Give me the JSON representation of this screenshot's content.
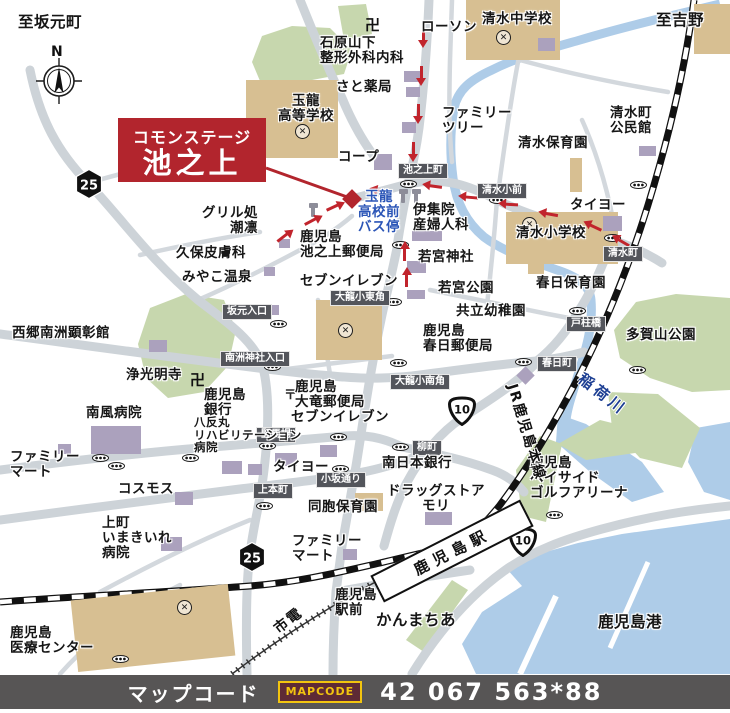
{
  "title_box": {
    "line1": "コモンステージ",
    "line2": "池之上"
  },
  "compass": {
    "label": "N"
  },
  "footer": {
    "label": "マップコード",
    "logo": "MAPCODE",
    "code": "42 067 563*88"
  },
  "station": {
    "name": "鹿児島駅"
  },
  "colors": {
    "accent_red": "#b2252d",
    "road": "#cdd3d8",
    "water": "#aecce8",
    "park_green": "#c7d7ae",
    "school_tan": "#d7bf92",
    "building_purple": "#aba1bd",
    "plate_bg": "#53555b",
    "footer_bg": "#575555",
    "mapcode_yellow": "#f2c40f"
  },
  "route_badges": [
    {
      "shape": "hex",
      "num": "25",
      "x": 89,
      "y": 184
    },
    {
      "shape": "hex",
      "num": "25",
      "x": 252,
      "y": 557
    },
    {
      "shape": "onigiri",
      "num": "10",
      "x": 462,
      "y": 411
    },
    {
      "shape": "onigiri",
      "num": "10",
      "x": 523,
      "y": 542
    }
  ],
  "labels": [
    {
      "t": "至坂元町",
      "x": 18,
      "y": 14,
      "c": "lg"
    },
    {
      "t": "至吉野",
      "x": 656,
      "y": 12,
      "c": "lg"
    },
    {
      "t": "ローソン",
      "x": 421,
      "y": 20
    },
    {
      "t": "清水中学校",
      "x": 482,
      "y": 12
    },
    {
      "t": "石原山下\n整形外科内科",
      "x": 320,
      "y": 36
    },
    {
      "t": "さと薬局",
      "x": 336,
      "y": 80
    },
    {
      "t": "玉龍\n高等学校",
      "x": 268,
      "y": 94,
      "c": "center",
      "w": 76
    },
    {
      "t": "ファミリー\nツリー",
      "x": 442,
      "y": 106
    },
    {
      "t": "清水町\n公民館",
      "x": 610,
      "y": 106
    },
    {
      "t": "清水保育園",
      "x": 518,
      "y": 136
    },
    {
      "t": "コープ",
      "x": 338,
      "y": 150
    },
    {
      "t": "タイヨー",
      "x": 570,
      "y": 198
    },
    {
      "t": "グリル処\n潮凛",
      "x": 168,
      "y": 206,
      "c": "right",
      "w": 90
    },
    {
      "t": "玉龍\n高校前\nバス停",
      "x": 350,
      "y": 190,
      "c": "blue center",
      "w": 58
    },
    {
      "t": "伊集院\n産婦人科",
      "x": 413,
      "y": 203
    },
    {
      "t": "清水小学校",
      "x": 516,
      "y": 226
    },
    {
      "t": "鹿児島\n池之上郵便局",
      "x": 300,
      "y": 230
    },
    {
      "t": "久保皮膚科",
      "x": 176,
      "y": 246
    },
    {
      "t": "若宮神社",
      "x": 418,
      "y": 250
    },
    {
      "t": "みやこ温泉",
      "x": 182,
      "y": 270
    },
    {
      "t": "セブンイレブン",
      "x": 300,
      "y": 274
    },
    {
      "t": "若宮公園",
      "x": 438,
      "y": 281
    },
    {
      "t": "春日保育園",
      "x": 536,
      "y": 276
    },
    {
      "t": "共立幼稚園",
      "x": 456,
      "y": 304
    },
    {
      "t": "多賀山公園",
      "x": 626,
      "y": 328
    },
    {
      "t": "西郷南洲顕彰館",
      "x": 12,
      "y": 326
    },
    {
      "t": "鹿児島\n春日郵便局",
      "x": 423,
      "y": 324
    },
    {
      "t": "浄光明寺",
      "x": 126,
      "y": 368
    },
    {
      "t": "南風病院",
      "x": 86,
      "y": 406
    },
    {
      "t": "鹿児島\n大竜郵便局",
      "x": 295,
      "y": 380
    },
    {
      "t": "鹿児島\n銀行",
      "x": 204,
      "y": 388
    },
    {
      "t": "セブンイレブン",
      "x": 291,
      "y": 410
    },
    {
      "t": "八反丸\nリハビリテーション\n病院",
      "x": 194,
      "y": 416,
      "c": "sm"
    },
    {
      "t": "南日本銀行",
      "x": 382,
      "y": 456
    },
    {
      "t": "タイヨー",
      "x": 273,
      "y": 460
    },
    {
      "t": "ファミリー\nマート",
      "x": 10,
      "y": 450
    },
    {
      "t": "コスモス",
      "x": 118,
      "y": 482
    },
    {
      "t": "ドラッグストア\nモリ",
      "x": 381,
      "y": 484,
      "c": "center",
      "w": 110
    },
    {
      "t": "同胞保育園",
      "x": 308,
      "y": 500
    },
    {
      "t": "上町\nいまきいれ\n病院",
      "x": 102,
      "y": 516
    },
    {
      "t": "ファミリー\nマート",
      "x": 292,
      "y": 534
    },
    {
      "t": "鹿児島\nベイサイド\nゴルフアリーナ",
      "x": 530,
      "y": 456
    },
    {
      "t": "鹿児島\n駅前",
      "x": 335,
      "y": 588
    },
    {
      "t": "かんまちあ",
      "x": 376,
      "y": 612,
      "c": "lg"
    },
    {
      "t": "鹿児島港",
      "x": 598,
      "y": 614,
      "c": "lg"
    },
    {
      "t": "鹿児島\n医療センター",
      "x": 10,
      "y": 626
    }
  ],
  "rotated_labels": [
    {
      "t": "JR鹿児島本線",
      "x": 527,
      "y": 432,
      "rot": 73,
      "c": ""
    },
    {
      "t": "市電",
      "x": 288,
      "y": 620,
      "rot": -38,
      "c": ""
    },
    {
      "t": "稲荷川",
      "x": 603,
      "y": 394,
      "rot": 38,
      "c": "river"
    }
  ],
  "plates": [
    {
      "t": "池之上町",
      "x": 398,
      "y": 163
    },
    {
      "t": "清水小前",
      "x": 477,
      "y": 183
    },
    {
      "t": "清水町",
      "x": 603,
      "y": 246
    },
    {
      "t": "大龍小東角",
      "x": 330,
      "y": 290
    },
    {
      "t": "坂元入口",
      "x": 222,
      "y": 304
    },
    {
      "t": "南洲神社入口",
      "x": 220,
      "y": 351
    },
    {
      "t": "戸柱橋",
      "x": 566,
      "y": 316
    },
    {
      "t": "春日町",
      "x": 537,
      "y": 356
    },
    {
      "t": "大龍小南角",
      "x": 390,
      "y": 374
    },
    {
      "t": "竪馬場",
      "x": 256,
      "y": 427
    },
    {
      "t": "柳町",
      "x": 412,
      "y": 440
    },
    {
      "t": "小坂通り",
      "x": 316,
      "y": 472
    },
    {
      "t": "上本町",
      "x": 253,
      "y": 483
    }
  ],
  "signals": [
    {
      "x": 408,
      "y": 184
    },
    {
      "x": 497,
      "y": 200
    },
    {
      "x": 638,
      "y": 185
    },
    {
      "x": 612,
      "y": 238
    },
    {
      "x": 400,
      "y": 245
    },
    {
      "x": 393,
      "y": 302
    },
    {
      "x": 278,
      "y": 324
    },
    {
      "x": 272,
      "y": 367
    },
    {
      "x": 523,
      "y": 362
    },
    {
      "x": 577,
      "y": 311
    },
    {
      "x": 637,
      "y": 370
    },
    {
      "x": 267,
      "y": 446
    },
    {
      "x": 338,
      "y": 437
    },
    {
      "x": 400,
      "y": 447
    },
    {
      "x": 340,
      "y": 469
    },
    {
      "x": 264,
      "y": 506
    },
    {
      "x": 100,
      "y": 458
    },
    {
      "x": 116,
      "y": 466
    },
    {
      "x": 190,
      "y": 458
    },
    {
      "x": 398,
      "y": 363
    },
    {
      "x": 554,
      "y": 515
    },
    {
      "x": 120,
      "y": 659
    }
  ],
  "schools": [
    {
      "x": 302,
      "y": 131
    },
    {
      "x": 503,
      "y": 37
    },
    {
      "x": 529,
      "y": 224
    },
    {
      "x": 345,
      "y": 330
    },
    {
      "x": 184,
      "y": 607
    }
  ],
  "manji": [
    {
      "x": 365,
      "y": 14
    },
    {
      "x": 190,
      "y": 369
    }
  ],
  "posts": [
    {
      "x": 284,
      "y": 384
    }
  ],
  "bus_poles": [
    {
      "x": 401,
      "y": 190
    },
    {
      "x": 414,
      "y": 190
    },
    {
      "x": 311,
      "y": 204
    }
  ],
  "arrows": [
    {
      "x": 424,
      "y": 34,
      "r": 90
    },
    {
      "x": 422,
      "y": 72,
      "r": 90
    },
    {
      "x": 419,
      "y": 110,
      "r": 90
    },
    {
      "x": 414,
      "y": 148,
      "r": 90
    },
    {
      "x": 436,
      "y": 186,
      "r": 188
    },
    {
      "x": 472,
      "y": 197,
      "r": 185
    },
    {
      "x": 512,
      "y": 204,
      "r": 183
    },
    {
      "x": 552,
      "y": 214,
      "r": 190
    },
    {
      "x": 596,
      "y": 227,
      "r": 205
    },
    {
      "x": 624,
      "y": 242,
      "r": 210
    },
    {
      "x": 407,
      "y": 280,
      "r": 270
    },
    {
      "x": 405,
      "y": 254,
      "r": 270
    },
    {
      "x": 283,
      "y": 237,
      "r": 322
    },
    {
      "x": 311,
      "y": 221,
      "r": 332
    },
    {
      "x": 333,
      "y": 207,
      "r": 335
    },
    {
      "x": 383,
      "y": 191,
      "r": 192
    }
  ],
  "buildings": [
    {
      "x": 246,
      "y": 80,
      "w": 92,
      "h": 78,
      "f": "t"
    },
    {
      "x": 466,
      "y": 0,
      "w": 94,
      "h": 60,
      "f": "t"
    },
    {
      "x": 506,
      "y": 212,
      "w": 112,
      "h": 52,
      "f": "t"
    },
    {
      "x": 316,
      "y": 300,
      "w": 66,
      "h": 60,
      "f": "t"
    },
    {
      "x": 74,
      "y": 592,
      "w": 158,
      "h": 72,
      "f": "t",
      "r": -6
    },
    {
      "x": 694,
      "y": 4,
      "w": 36,
      "h": 50,
      "f": "t"
    },
    {
      "x": 570,
      "y": 158,
      "w": 12,
      "h": 34,
      "f": "t"
    },
    {
      "x": 528,
      "y": 260,
      "w": 16,
      "h": 14,
      "f": "t"
    },
    {
      "x": 355,
      "y": 493,
      "w": 28,
      "h": 18,
      "f": "t"
    },
    {
      "x": 538,
      "y": 38,
      "w": 17,
      "h": 13,
      "f": "p"
    },
    {
      "x": 404,
      "y": 71,
      "w": 17,
      "h": 11,
      "f": "p"
    },
    {
      "x": 406,
      "y": 87,
      "w": 14,
      "h": 10,
      "f": "p"
    },
    {
      "x": 402,
      "y": 122,
      "w": 14,
      "h": 11,
      "f": "p"
    },
    {
      "x": 374,
      "y": 154,
      "w": 18,
      "h": 16,
      "f": "p"
    },
    {
      "x": 412,
      "y": 231,
      "w": 30,
      "h": 10,
      "f": "p"
    },
    {
      "x": 407,
      "y": 261,
      "w": 19,
      "h": 12,
      "f": "p"
    },
    {
      "x": 407,
      "y": 290,
      "w": 18,
      "h": 9,
      "f": "p"
    },
    {
      "x": 603,
      "y": 216,
      "w": 19,
      "h": 15,
      "f": "p"
    },
    {
      "x": 639,
      "y": 146,
      "w": 17,
      "h": 10,
      "f": "p"
    },
    {
      "x": 149,
      "y": 340,
      "w": 18,
      "h": 12,
      "f": "p"
    },
    {
      "x": 266,
      "y": 305,
      "w": 13,
      "h": 10,
      "f": "p"
    },
    {
      "x": 519,
      "y": 369,
      "w": 13,
      "h": 13,
      "f": "p",
      "r": 45
    },
    {
      "x": 279,
      "y": 239,
      "w": 11,
      "h": 9,
      "f": "p"
    },
    {
      "x": 264,
      "y": 267,
      "w": 11,
      "h": 9,
      "f": "p"
    },
    {
      "x": 91,
      "y": 426,
      "w": 50,
      "h": 28,
      "f": "p"
    },
    {
      "x": 58,
      "y": 444,
      "w": 13,
      "h": 10,
      "f": "p"
    },
    {
      "x": 175,
      "y": 492,
      "w": 18,
      "h": 13,
      "f": "p"
    },
    {
      "x": 161,
      "y": 537,
      "w": 21,
      "h": 14,
      "f": "p"
    },
    {
      "x": 320,
      "y": 445,
      "w": 17,
      "h": 12,
      "f": "p"
    },
    {
      "x": 275,
      "y": 453,
      "w": 22,
      "h": 13,
      "f": "p"
    },
    {
      "x": 222,
      "y": 461,
      "w": 20,
      "h": 13,
      "f": "p"
    },
    {
      "x": 248,
      "y": 464,
      "w": 14,
      "h": 11,
      "f": "p"
    },
    {
      "x": 425,
      "y": 512,
      "w": 27,
      "h": 13,
      "f": "p"
    },
    {
      "x": 343,
      "y": 549,
      "w": 14,
      "h": 11,
      "f": "p"
    }
  ]
}
